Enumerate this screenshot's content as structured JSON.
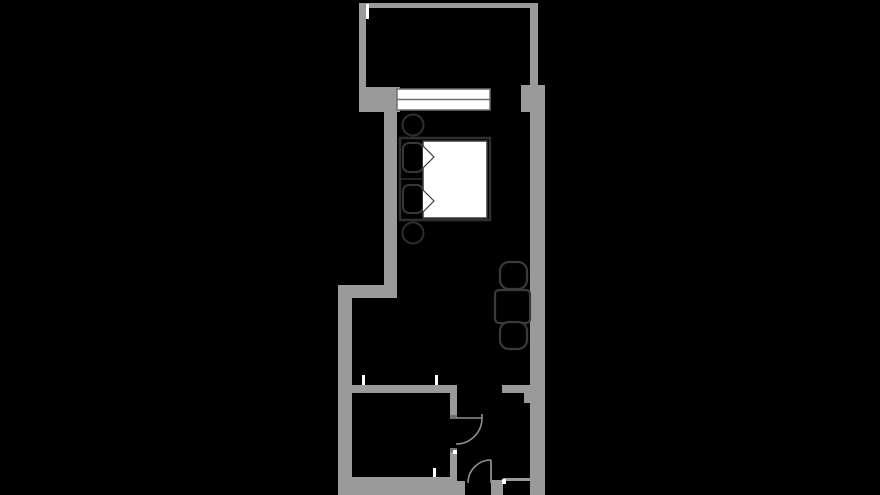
{
  "canvas": {
    "width": 880,
    "height": 495,
    "background": "#000000"
  },
  "palette": {
    "wall": "#9a9a9a",
    "wall_dark": "#6f6f6f",
    "furniture_stroke": "#333333",
    "door_stroke": "#8f8f8f",
    "white": "#ffffff",
    "background": "#000000"
  },
  "floorplan": {
    "elements": [
      {
        "name": "top-wall",
        "type": "rect",
        "x": 359,
        "y": 3,
        "w": 179,
        "h": 5,
        "fill": "#9a9a9a"
      },
      {
        "name": "balcony-left-wall",
        "type": "rect",
        "x": 359,
        "y": 3,
        "w": 7,
        "h": 85,
        "fill": "#9a9a9a"
      },
      {
        "name": "balcony-right-wall",
        "type": "rect",
        "x": 530,
        "y": 3,
        "w": 8,
        "h": 82,
        "fill": "#9a9a9a"
      },
      {
        "name": "window-sill-wall",
        "type": "rect",
        "x": 359,
        "y": 87,
        "w": 41,
        "h": 25,
        "fill": "#9a9a9a"
      },
      {
        "name": "right-wall-pillar",
        "type": "rect",
        "x": 521,
        "y": 85,
        "w": 24,
        "h": 27,
        "fill": "#9a9a9a"
      },
      {
        "name": "left-wall-upper",
        "type": "rect",
        "x": 384,
        "y": 110,
        "w": 13,
        "h": 180,
        "fill": "#9a9a9a"
      },
      {
        "name": "left-wall-jog",
        "type": "rect",
        "x": 338,
        "y": 285,
        "w": 59,
        "h": 13,
        "fill": "#9a9a9a"
      },
      {
        "name": "left-wall-lower",
        "type": "rect",
        "x": 338,
        "y": 298,
        "w": 14,
        "h": 197,
        "fill": "#9a9a9a"
      },
      {
        "name": "right-wall",
        "type": "rect",
        "x": 530,
        "y": 85,
        "w": 15,
        "h": 410,
        "fill": "#9a9a9a"
      },
      {
        "name": "bathroom-top-wall",
        "type": "rect",
        "x": 352,
        "y": 385,
        "w": 105,
        "h": 8,
        "fill": "#9a9a9a"
      },
      {
        "name": "bathroom-door-jamb-upper",
        "type": "rect",
        "x": 450,
        "y": 385,
        "w": 7,
        "h": 30,
        "fill": "#9a9a9a"
      },
      {
        "name": "bathroom-door-jamb-lower",
        "type": "rect",
        "x": 450,
        "y": 449,
        "w": 7,
        "h": 46,
        "fill": "#9a9a9a"
      },
      {
        "name": "bathroom-bottom-wall",
        "type": "rect",
        "x": 338,
        "y": 477,
        "w": 119,
        "h": 18,
        "fill": "#9a9a9a"
      },
      {
        "name": "entry-left-jamb-block",
        "type": "rect",
        "x": 455,
        "y": 481,
        "w": 10,
        "h": 14,
        "fill": "#9a9a9a"
      },
      {
        "name": "entry-wall-stub",
        "type": "rect",
        "x": 502,
        "y": 385,
        "w": 28,
        "h": 8,
        "fill": "#9a9a9a"
      },
      {
        "name": "entry-stub-return",
        "type": "rect",
        "x": 524,
        "y": 393,
        "w": 6,
        "h": 10,
        "fill": "#9a9a9a"
      },
      {
        "name": "entry-right-jamb",
        "type": "rect",
        "x": 491,
        "y": 480,
        "w": 12,
        "h": 15,
        "fill": "#9a9a9a"
      },
      {
        "name": "closet-front-wall",
        "type": "rect",
        "x": 503,
        "y": 478,
        "w": 29,
        "h": 3,
        "fill": "#9a9a9a"
      },
      {
        "name": "door-hinge-plate-upper",
        "type": "rect",
        "x": 450,
        "y": 415,
        "w": 7,
        "h": 4,
        "fill": "#6f6f6f"
      },
      {
        "name": "door-hinge-plate-lower",
        "type": "rect",
        "x": 450,
        "y": 448,
        "w": 7,
        "h": 4,
        "fill": "#6f6f6f"
      },
      {
        "name": "wall-tv-niche",
        "type": "rect",
        "x": 527,
        "y": 148,
        "w": 3,
        "h": 60,
        "fill": "#000000"
      },
      {
        "name": "window-frame",
        "type": "rect",
        "x": 397,
        "y": 89,
        "w": 93,
        "h": 21,
        "fill": "#ffffff",
        "stroke": "#6f6f6f",
        "sw": 1.5
      },
      {
        "name": "window-divider",
        "type": "line",
        "x1": 397,
        "y1": 99.5,
        "x2": 490,
        "y2": 99.5,
        "stroke": "#6f6f6f",
        "sw": 1.5
      },
      {
        "name": "stool-top",
        "type": "circle",
        "cx": 413,
        "cy": 125,
        "r": 10.5,
        "fill": "#000000",
        "stroke": "#2f2f2f",
        "sw": 2
      },
      {
        "name": "stool-bottom",
        "type": "circle",
        "cx": 413,
        "cy": 233,
        "r": 10.5,
        "fill": "#000000",
        "stroke": "#2f2f2f",
        "sw": 2
      },
      {
        "name": "bed-frame",
        "type": "rect",
        "x": 400,
        "y": 138,
        "w": 90,
        "h": 82,
        "fill": "#000000",
        "stroke": "#2f2f2f",
        "sw": 2.5
      },
      {
        "name": "bed-duvet",
        "type": "rect",
        "x": 423,
        "y": 141,
        "w": 64,
        "h": 77,
        "fill": "#ffffff",
        "stroke": "#3a3a3a",
        "sw": 1.5
      },
      {
        "name": "pillow-divider",
        "type": "line",
        "x1": 401,
        "y1": 179,
        "x2": 423,
        "y2": 179,
        "stroke": "#2f2f2f",
        "sw": 1.5
      },
      {
        "name": "bed-pillow-top",
        "type": "rect",
        "x": 403,
        "y": 143,
        "w": 20,
        "h": 29,
        "rx": 6,
        "fill": "#000000",
        "stroke": "#383838",
        "sw": 2
      },
      {
        "name": "bed-pillow-bottom",
        "type": "rect",
        "x": 403,
        "y": 185,
        "w": 20,
        "h": 28,
        "rx": 6,
        "fill": "#000000",
        "stroke": "#383838",
        "sw": 2
      },
      {
        "name": "duvet-fold-top",
        "type": "path",
        "d": "M423,146 L434,157 L423,168",
        "fill": "#ffffff",
        "stroke": "#3a3a3a",
        "sw": 1.2
      },
      {
        "name": "duvet-fold-bottom",
        "type": "path",
        "d": "M423,190 L434,201 L423,212",
        "fill": "#ffffff",
        "stroke": "#3a3a3a",
        "sw": 1.2
      },
      {
        "name": "dining-table",
        "type": "rect",
        "x": 495,
        "y": 290,
        "w": 35,
        "h": 33,
        "rx": 4,
        "fill": "#000000",
        "stroke": "#3a3a3a",
        "sw": 2.2
      },
      {
        "name": "chair-top",
        "type": "rect",
        "x": 500,
        "y": 262,
        "w": 27,
        "h": 27,
        "rx": 9,
        "fill": "#000000",
        "stroke": "#3a3a3a",
        "sw": 2.2
      },
      {
        "name": "chair-bottom",
        "type": "rect",
        "x": 500,
        "y": 322,
        "w": 27,
        "h": 27,
        "rx": 9,
        "fill": "#000000",
        "stroke": "#3a3a3a",
        "sw": 2.2
      },
      {
        "name": "bathroom-door-leaf",
        "type": "path",
        "d": "M456,418 L482,418 L482,414",
        "fill": "none",
        "stroke": "#8f8f8f",
        "sw": 1.6
      },
      {
        "name": "bathroom-door-swing",
        "type": "path",
        "d": "M482,418 A26,26 0 0 1 456,444",
        "fill": "none",
        "stroke": "#8f8f8f",
        "sw": 1.6
      },
      {
        "name": "entry-door-leaf",
        "type": "line",
        "x1": 491,
        "y1": 460,
        "x2": 491,
        "y2": 483,
        "stroke": "#8f8f8f",
        "sw": 1.8
      },
      {
        "name": "entry-door-swing",
        "type": "path",
        "d": "M491,460 A23,23 0 0 0 468,483",
        "fill": "none",
        "stroke": "#8f8f8f",
        "sw": 1.6
      },
      {
        "name": "wall-tick-balcony",
        "type": "rect",
        "x": 366,
        "y": 4,
        "w": 3,
        "h": 15,
        "fill": "#ffffff"
      },
      {
        "name": "wall-tick-bathroom-top-left",
        "type": "rect",
        "x": 362,
        "y": 375,
        "w": 3,
        "h": 10,
        "fill": "#ffffff"
      },
      {
        "name": "wall-tick-bathroom-top-right",
        "type": "rect",
        "x": 435,
        "y": 375,
        "w": 3,
        "h": 10,
        "fill": "#ffffff"
      },
      {
        "name": "wall-tick-bathroom-bottom",
        "type": "rect",
        "x": 433,
        "y": 468,
        "w": 3,
        "h": 9,
        "fill": "#ffffff"
      },
      {
        "name": "wall-tick-entry-jamb",
        "type": "rect",
        "x": 453,
        "y": 450,
        "w": 4,
        "h": 4,
        "fill": "#ffffff"
      },
      {
        "name": "wall-tick-closet",
        "type": "rect",
        "x": 502,
        "y": 479,
        "w": 4,
        "h": 5,
        "fill": "#ffffff"
      }
    ]
  }
}
